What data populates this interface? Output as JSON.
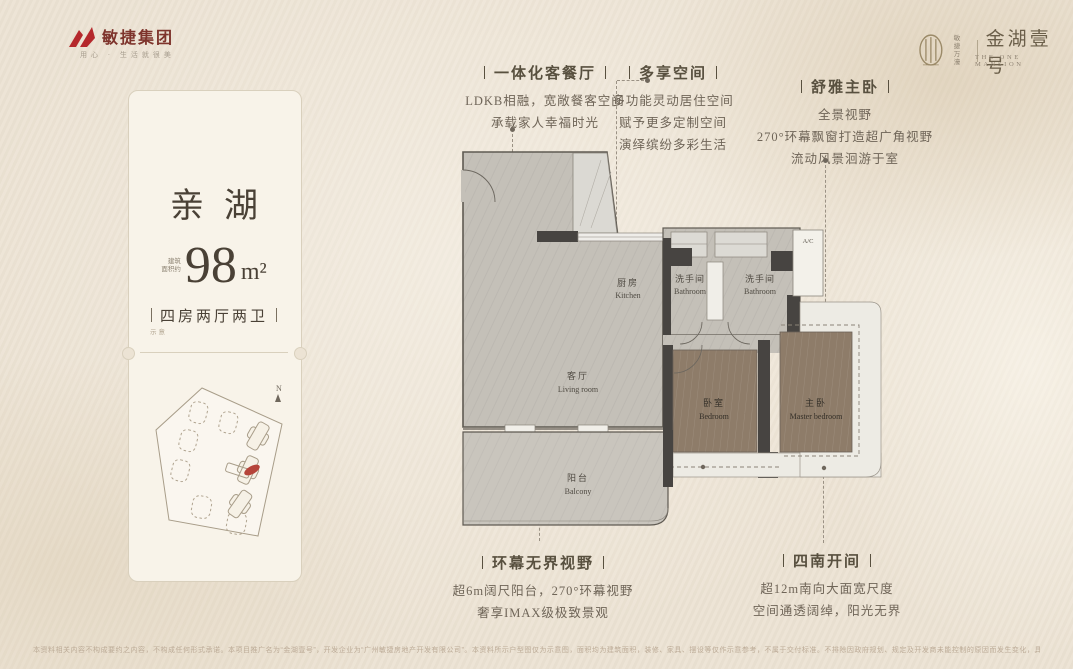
{
  "header": {
    "left_logo": {
      "company": "敏捷集团",
      "slogan": "用心 · 生活就很美"
    },
    "right_logo": {
      "tag_line1": "敏捷",
      "tag_line2": "万濠",
      "project": "金湖壹号",
      "project_en": "THE ONE MANSION"
    }
  },
  "card": {
    "title": "亲湖",
    "area_label_line1": "建筑",
    "area_label_line2": "面积约",
    "area_value": "98",
    "area_unit": "m²",
    "layout": "四房两厅两卫",
    "layout_note": "示意",
    "north": "N"
  },
  "annotations": {
    "top": [
      {
        "title": "一体化客餐厅",
        "lines": [
          "LDKB相融，宽敞餐客空间",
          "承载家人幸福时光"
        ]
      },
      {
        "title": "多享空间",
        "lines": [
          "多功能灵动居住空间",
          "赋予更多定制空间",
          "演绎缤纷多彩生活"
        ]
      },
      {
        "title": "舒雅主卧",
        "lines": [
          "全景视野",
          "270°环幕飘窗打造超广角视野",
          "流动风景洄游于室"
        ]
      }
    ],
    "bottom": [
      {
        "title": "环幕无界视野",
        "lines": [
          "超6m阔尺阳台，270°环幕视野",
          "奢享IMAX级极致景观"
        ]
      },
      {
        "title": "四南开间",
        "lines": [
          "超12m南向大面宽尺度",
          "空间通透阔绰，阳光无界"
        ]
      }
    ]
  },
  "plan": {
    "kitchen_cn": "厨房",
    "kitchen_en": "Kitchen",
    "bathroom_cn": "洗手间",
    "bathroom_en": "Bathroom",
    "living_cn": "客厅",
    "living_en": "Living room",
    "balcony_cn": "阳台",
    "balcony_en": "Balcony",
    "bedroom_cn": "卧室",
    "bedroom_en": "Bedroom",
    "master_cn": "主卧",
    "master_en": "Master bedroom",
    "ac_label": "A/C"
  },
  "colors": {
    "brand_red": "#b5282c",
    "unit_red": "#b5443a",
    "wall": "#474441",
    "wood": "#8e7c69"
  },
  "footer": {
    "disclaimer": "本资料相关内容不构成要约之内容，不构成任何形式承诺。本项目推广名为“金湖壹号”，开发企业为“广州敏捷房地产开发有限公司”。本资料所示户型图仅为示意图，面积均为建筑面积，装修、家具、摆设等仅作示意参考，不属于交付标准。不排除因政府规划、规定及开发商未能控制的原因而发生变化，具体以政府批准文件及商品房买卖合同约定为准，敬请留意最新资料。"
  }
}
